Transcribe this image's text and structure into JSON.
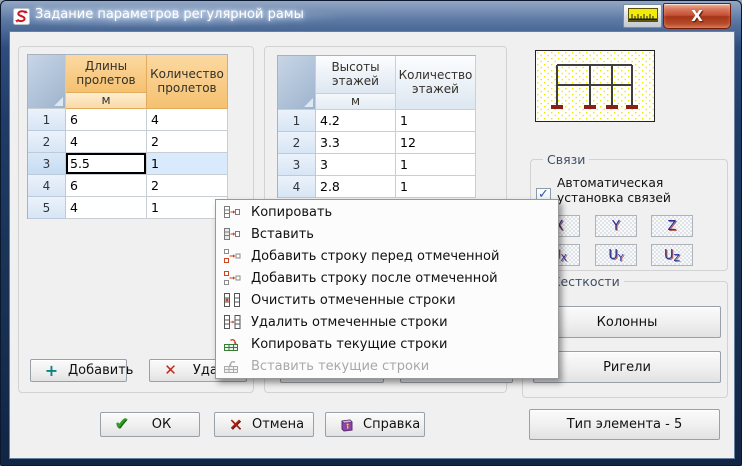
{
  "titlebar": {
    "title": "Задание параметров регулярной рамы",
    "app_icon": "scad-logo-icon",
    "ruler_icon": "ruler-icon",
    "close_label": "X"
  },
  "span_table": {
    "header": "Длины пролетов",
    "unit": "м",
    "count_header": "Количество пролетов",
    "rows": [
      {
        "num": "1",
        "value": "6",
        "count": "4"
      },
      {
        "num": "2",
        "value": "4",
        "count": "2"
      },
      {
        "num": "3",
        "value": "5.5",
        "count": "1"
      },
      {
        "num": "4",
        "value": "6",
        "count": "2"
      },
      {
        "num": "5",
        "value": "4",
        "count": "1"
      }
    ],
    "selected_row_index": 2,
    "selected_cell": "value"
  },
  "floor_table": {
    "header": "Высоты этажей",
    "unit": "м",
    "count_header": "Количество этажей",
    "rows": [
      {
        "num": "1",
        "value": "4.2",
        "count": "1"
      },
      {
        "num": "2",
        "value": "3.3",
        "count": "12"
      },
      {
        "num": "3",
        "value": "3",
        "count": "1"
      },
      {
        "num": "4",
        "value": "2.8",
        "count": "1"
      }
    ]
  },
  "span_buttons": {
    "add": "Добавить",
    "add_icon": "plus-icon",
    "delete_visible": "Удал",
    "delete_icon": "red-x-icon"
  },
  "context_menu": {
    "items": [
      {
        "label": "Копировать",
        "icon": "copy-cells-icon",
        "enabled": true
      },
      {
        "label": "Вставить",
        "icon": "paste-cells-icon",
        "enabled": true
      },
      {
        "label": "Добавить строку перед отмеченной",
        "icon": "insert-row-before-icon",
        "enabled": true
      },
      {
        "label": "Добавить строку после отмеченной",
        "icon": "insert-row-after-icon",
        "enabled": true
      },
      {
        "label": "Очистить отмеченные строки",
        "icon": "clear-rows-icon",
        "enabled": true
      },
      {
        "label": "Удалить отмеченные строки",
        "icon": "delete-rows-icon",
        "enabled": true
      },
      {
        "label": "Копировать текущие строки",
        "icon": "copy-current-rows-icon",
        "enabled": true
      },
      {
        "label": "Вставить текущие строки",
        "icon": "paste-current-rows-icon",
        "enabled": false
      }
    ]
  },
  "links": {
    "label": "Связи",
    "auto_checkbox_label": "Автоматическая установка связей",
    "checked": true,
    "buttons": [
      {
        "main": "X",
        "sub": ""
      },
      {
        "main": "Y",
        "sub": ""
      },
      {
        "main": "Z",
        "sub": ""
      },
      {
        "main": "U",
        "sub": "X"
      },
      {
        "main": "U",
        "sub": "Y"
      },
      {
        "main": "U",
        "sub": "Z"
      }
    ]
  },
  "stiffness": {
    "label": "Жесткости",
    "columns_button": "Колонны",
    "beams_button": "Ригели"
  },
  "element_type_button": "Тип элемента - 5",
  "dialog_buttons": {
    "ok": "ОК",
    "ok_icon": "green-check-icon",
    "cancel": "Отмена",
    "cancel_icon": "red-x-icon",
    "help": "Справка",
    "help_icon": "help-book-icon"
  },
  "colors": {
    "titlebar_blue": "#1e3a63",
    "header_orange": "#f5c170",
    "selection_blue": "#d9eafc",
    "close_button_red": "#c34e32",
    "diagram_dot_yellow": "#f0e600",
    "support_red": "#8b1f14"
  }
}
